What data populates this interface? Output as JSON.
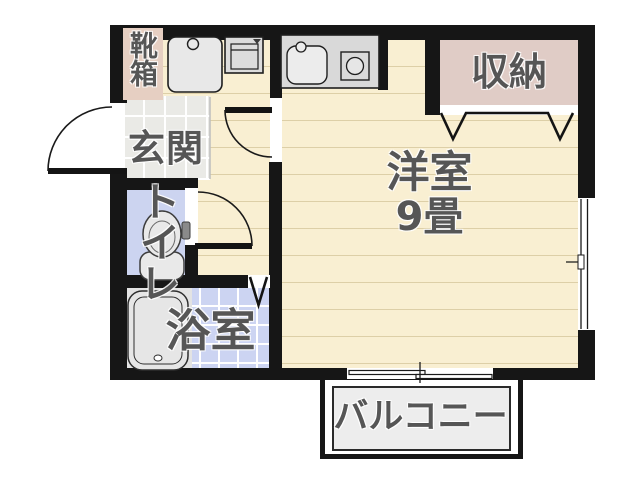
{
  "floor_plan": {
    "rooms": {
      "shoe_box": {
        "label": "靴箱"
      },
      "genkan": {
        "label": "玄関"
      },
      "toilet": {
        "label": "トイレ"
      },
      "bathroom": {
        "label": "浴室"
      },
      "main_room": {
        "label": "洋室",
        "size": "9畳"
      },
      "closet": {
        "label": "収納"
      },
      "balcony": {
        "label": "バルコニー"
      }
    },
    "icons": {
      "washing_machine": "washing-machine-pan",
      "refrigerator": "refrigerator-space",
      "sink": "kitchen-sink",
      "stove": "single-burner-stove",
      "toilet_fixture": "toilet-bowl",
      "bathtub": "bathtub",
      "doors": [
        "swing-door-entrance",
        "swing-door-main-room",
        "swing-door-toilet",
        "bifold-door-bathroom",
        "bifold-door-closet",
        "sliding-door-balcony",
        "window-right-wall"
      ]
    },
    "colors": {
      "wall": "#161616",
      "wood_floor": "#f9efd2",
      "tile_floor_gray": "#eaeae6",
      "wet_area_blue": "#ccd4f2",
      "closet_pink": "#e0ccc6",
      "balcony_gray": "#ededed",
      "fixture_gray": "#d9d9d9",
      "label_text": "#565656"
    }
  }
}
